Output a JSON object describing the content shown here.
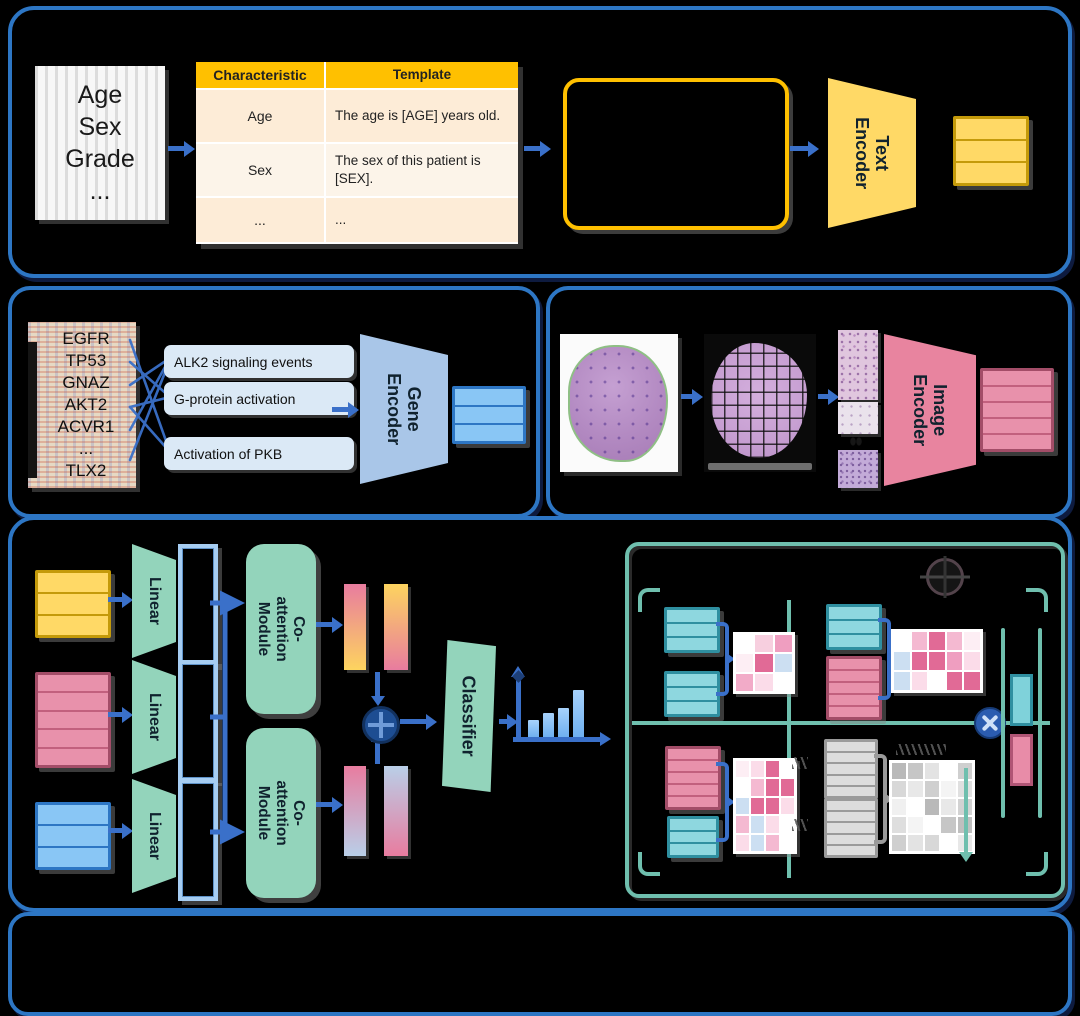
{
  "clinical": {
    "document_lines": [
      "Age",
      "Sex",
      "Grade",
      "..."
    ],
    "table": {
      "headers": [
        "Characteristic",
        "Template"
      ],
      "rows": [
        {
          "characteristic": "Age",
          "template": "The age is [AGE] years old."
        },
        {
          "characteristic": "Sex",
          "template": "The sex of this patient is [SEX]."
        },
        {
          "characteristic": "...",
          "template": "..."
        }
      ]
    },
    "encoder_label": "Text Encoder"
  },
  "genomic": {
    "genes": [
      "EGFR",
      "TP53",
      "GNAZ",
      "AKT2",
      "ACVR1",
      "...",
      "TLX2"
    ],
    "pathways": [
      "ALK2 signaling events",
      "G-protein activation",
      "Activation of PKB"
    ],
    "encoder_label": "Gene Encoder"
  },
  "pathology": {
    "encoder_label": "Image Encoder"
  },
  "fusion": {
    "linear_labels": [
      "Linear",
      "Linear",
      "Linear"
    ],
    "coattention_labels": [
      "Co-attention Module",
      "Co-attention Module"
    ],
    "classifier_label": "Classifier",
    "output_bar_heights": [
      17,
      24,
      29,
      47
    ]
  },
  "detail": {
    "heatmaps": {
      "top_left": [
        [
          "#ffffff",
          "#f7cfdf",
          "#ef9ec0"
        ],
        [
          "#fdeef4",
          "#e16a96",
          "#ccdff2"
        ],
        [
          "#f2abc8",
          "#fbdce9",
          "#ffffff"
        ]
      ],
      "top_right": [
        [
          "#ffffff",
          "#f4b9d1",
          "#e16a96",
          "#f4b9d1",
          "#fdeef4"
        ],
        [
          "#ccdff2",
          "#e16a96",
          "#e16a96",
          "#ef9ec0",
          "#fbdce9"
        ],
        [
          "#ccdff2",
          "#fbdce9",
          "#ffffff",
          "#e16a96",
          "#e16a96"
        ]
      ],
      "bottom_left": [
        [
          "#fdeef4",
          "#fbdce9",
          "#e16a96",
          "#ffffff"
        ],
        [
          "#ffffff",
          "#f4b9d1",
          "#e16a96",
          "#e16a96"
        ],
        [
          "#ccdff2",
          "#e16a96",
          "#e16a96",
          "#fbdce9"
        ],
        [
          "#f4b9d1",
          "#ccdff2",
          "#fbdce9",
          "#ffffff"
        ],
        [
          "#fbdce9",
          "#ccdff2",
          "#f4b9d1",
          "#ffffff"
        ]
      ],
      "bottom_right_gray": [
        [
          "#b9b9b9",
          "#c6c6c6",
          "#e3e3e3",
          "#ffffff",
          "#cfcfcf"
        ],
        [
          "#d8d8d8",
          "#e8e8e8",
          "#cfcfcf",
          "#f4f4f4",
          "#e0e0e0"
        ],
        [
          "#f0f0f0",
          "#ffffff",
          "#b9b9b9",
          "#e8e8e8",
          "#d2d2d2"
        ],
        [
          "#dedede",
          "#f4f4f4",
          "#ffffff",
          "#c6c6c6",
          "#bfbfbf"
        ],
        [
          "#cfcfcf",
          "#e3e3e3",
          "#d8d8d8",
          "#ffffff",
          "#e8e8e8"
        ]
      ]
    }
  },
  "icons": {
    "fusion_operator": "circled-plus",
    "attention_operator": "circled-times",
    "frozen_marker": "snowflake"
  },
  "colors": {
    "panel_border": "#2d76c4",
    "arrow_blue": "#3a70c9",
    "text_yellow": "#ffd966",
    "table_header_orange": "#ffc000",
    "gene_blue": "#a9c6e8",
    "image_pink": "#e8849f",
    "module_green": "#93d4bb",
    "detail_teal": "#6fbfae"
  }
}
